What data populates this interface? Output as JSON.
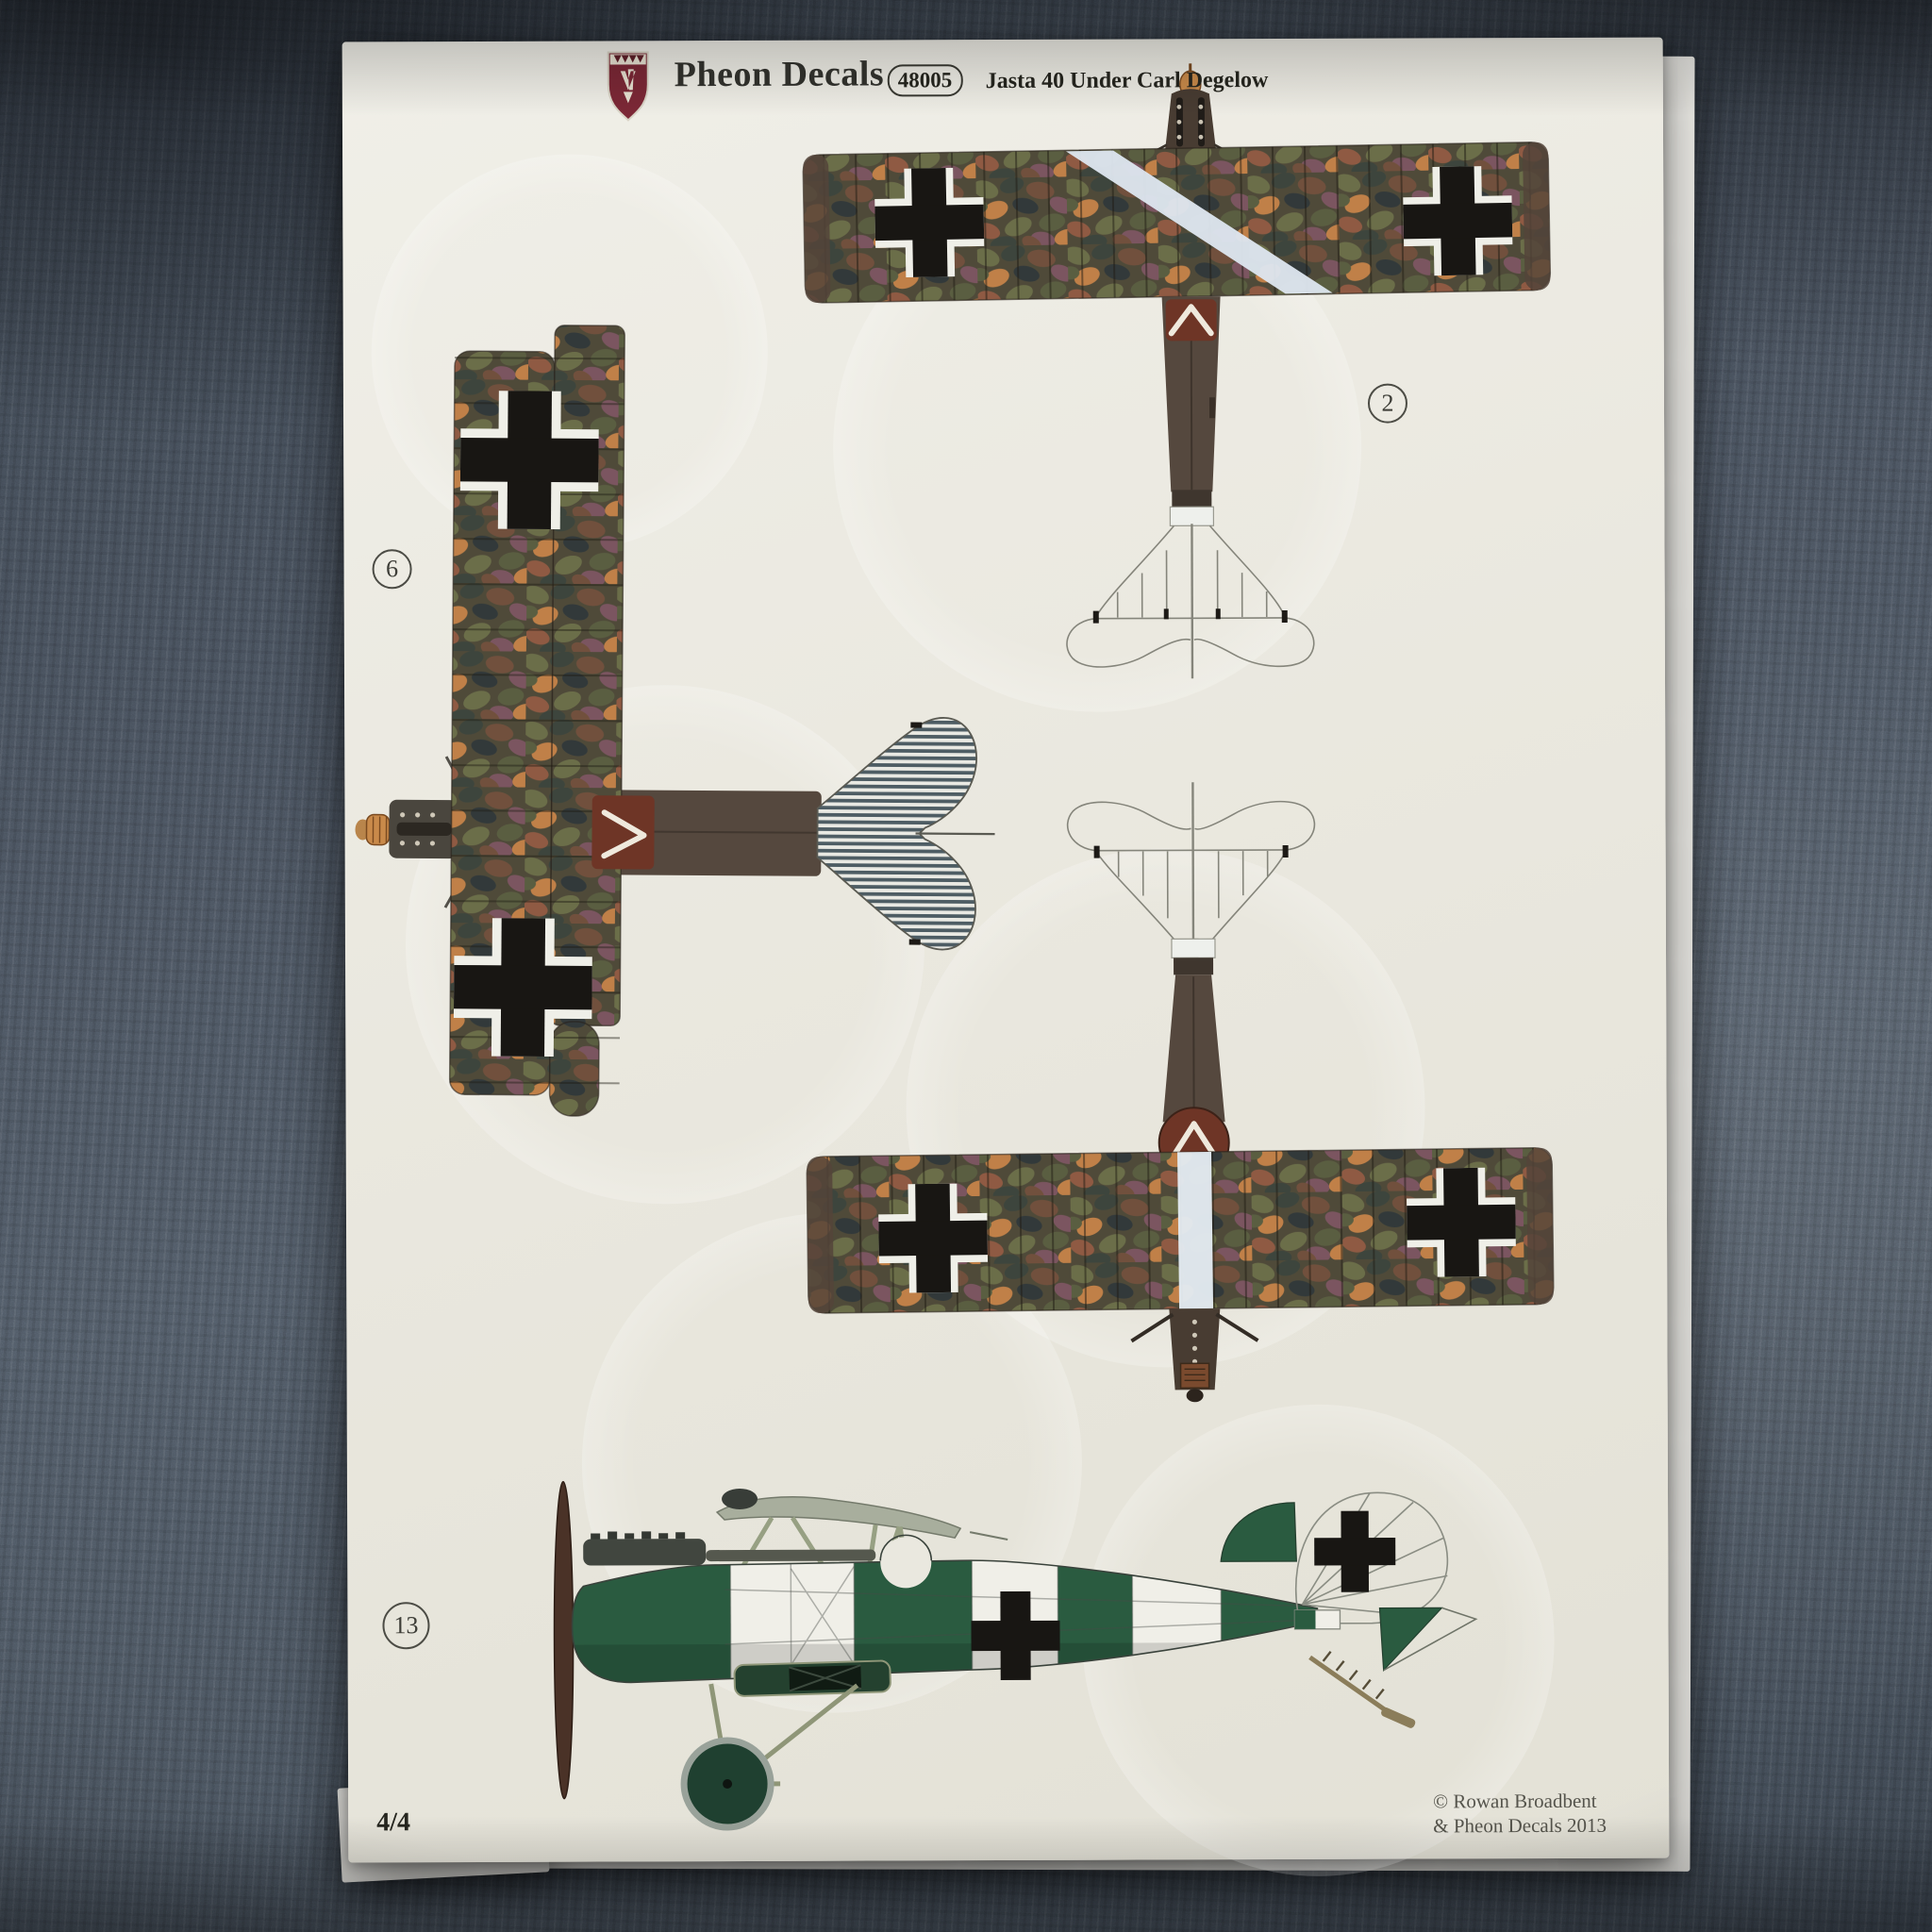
{
  "header": {
    "brand": "Pheon Decals",
    "product_code": "48005",
    "title": "Jasta 40 Under Carl Degelow",
    "logo": "pheon-shield-crest"
  },
  "scheme_labels": {
    "top_view": "2",
    "plan_view": "6",
    "side_view": "13"
  },
  "footer": {
    "page_number": "4/4",
    "copyright_line1": "© Rowan Broadbent",
    "copyright_line2": "& Pheon Decals 2013"
  },
  "colors": {
    "paper": "#eae8df",
    "table": "#49525e",
    "green": "#2a5b40",
    "brown": "#55483e",
    "maroon": "#6e3526",
    "stripeblue": "#4e5d64",
    "crossink": "#181613",
    "ochre": "#c98a4a",
    "shieldred": "#7c2836"
  }
}
